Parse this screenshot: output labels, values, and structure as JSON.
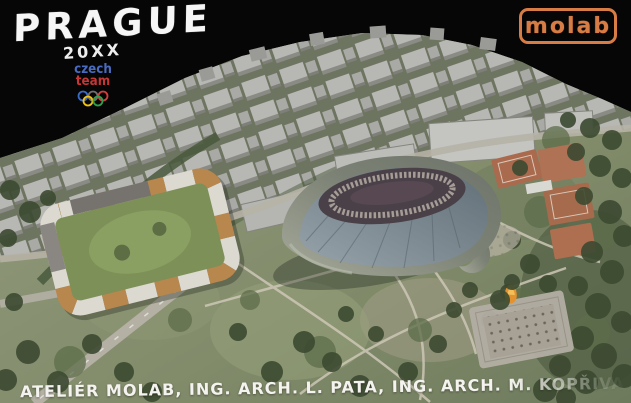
{
  "poster": {
    "title": "PRAGUE",
    "year": "20XX",
    "credits": "ATELIÉR MOLAB, ING. ARCH. L. PATA, ING. ARCH. M. KOPŘIVA, DOC. DR. H. ACHTEN"
  },
  "logos": {
    "czech_team": {
      "line1": "czech",
      "line2": "team",
      "ring_colors": [
        "#3a6bc6",
        "#f2c212",
        "#6f6f6f",
        "#2f9e4f",
        "#d23f3f"
      ]
    },
    "molab": {
      "label": "molab",
      "color": "#d87c45"
    }
  },
  "scene": {
    "landmarks": [
      "city-block-model",
      "stadium",
      "courtyard-housing-block",
      "letna-park",
      "tennis-courts",
      "metronome-plaza",
      "flame-sculpture"
    ]
  },
  "colors": {
    "background": "#060606",
    "title_text": "#f6f6f6",
    "molab_orange": "#d87c45",
    "czech_blue": "#4a6cc0",
    "team_red": "#c53636",
    "park_green": "#87906f",
    "tree_green": "#3c4a31",
    "model_gray": "#b6b6b2",
    "stadium_rim": "#8f958a",
    "stadium_roof": "#7d8b95",
    "facade_orange": "#b8874e",
    "clay_court": "#a96a4e",
    "road_gray": "#b4b0a4"
  }
}
